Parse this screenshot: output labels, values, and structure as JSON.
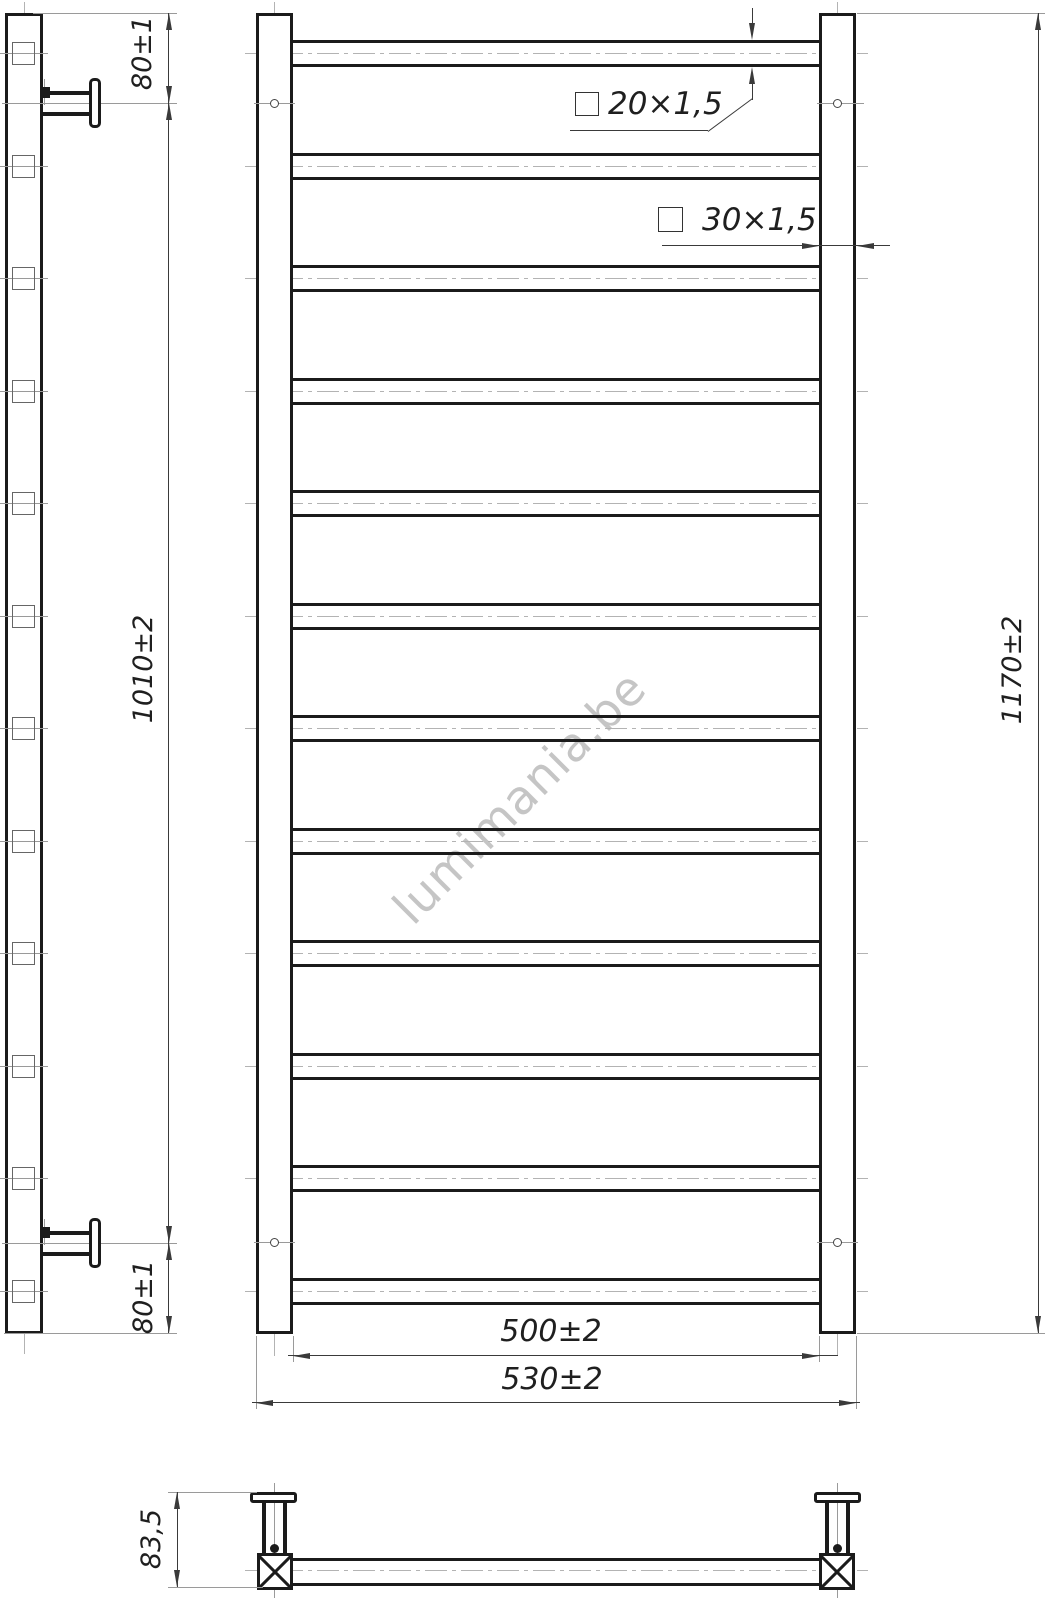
{
  "watermark": {
    "text": "lumimania.be"
  },
  "specs": {
    "rung_tube": "20×1,5",
    "post_tube": "30×1,5"
  },
  "dimensions": {
    "top_offset": "80±1",
    "bracket_span": "1010±2",
    "bottom_offset": "80±1",
    "total_height": "1170±2",
    "inner_width": "500±2",
    "outer_width": "530±2",
    "depth": "83,5"
  },
  "structure": {
    "rung_count": 12
  },
  "colors": {
    "line_color": "#1b1b1b",
    "dim_color": "#3a3a3a",
    "extension_color": "#9a9a9a",
    "centerline_color": "#b3b3b3",
    "watermark_color": "#bfbfbf"
  }
}
